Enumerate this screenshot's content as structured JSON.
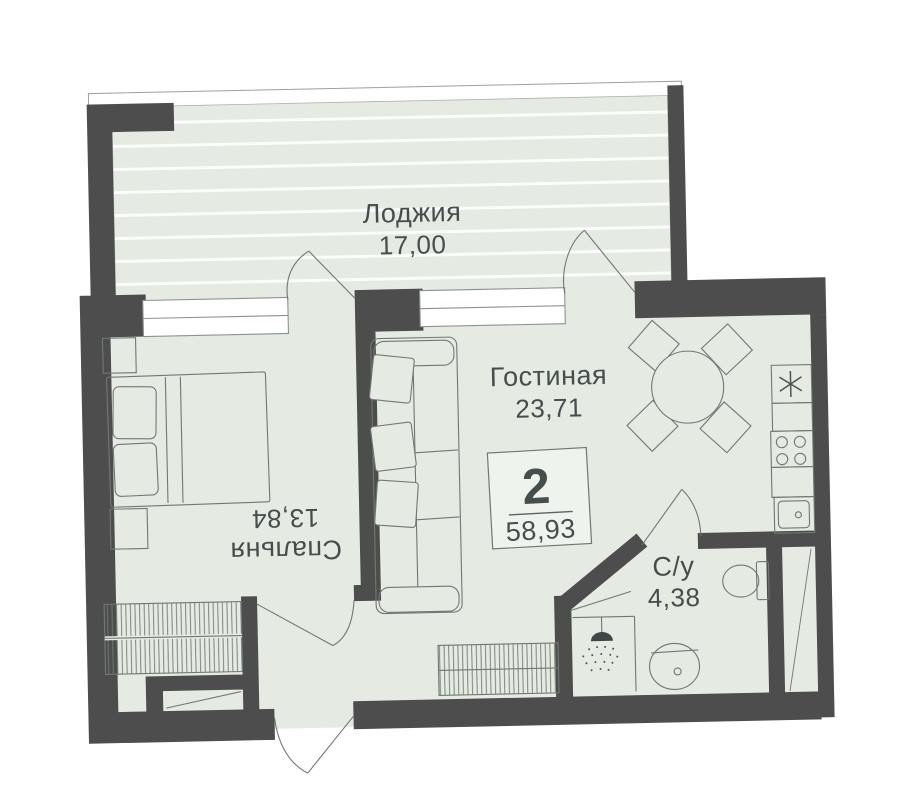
{
  "apartment": {
    "rooms_count": "2",
    "total_area": "58,93"
  },
  "rooms": {
    "loggia": {
      "name": "Лоджия",
      "area": "17,00"
    },
    "living": {
      "name": "Гостиная",
      "area": "23,71"
    },
    "bedroom": {
      "name": "Спальня",
      "area": "13,84"
    },
    "bathroom": {
      "name": "С/у",
      "area": "4,38"
    }
  },
  "icons": {
    "hob_symbol": "asterisk",
    "shower": "shower-head-with-spray",
    "cooktop": "four-burners",
    "sink": "basin-with-drain"
  },
  "colors": {
    "wall": "#4d4d4d",
    "floor": "#e5eae2",
    "stripe": "#fbfdfa",
    "furniture_line": "#6f7974",
    "text": "#454e4d",
    "window": "#ffffff"
  }
}
